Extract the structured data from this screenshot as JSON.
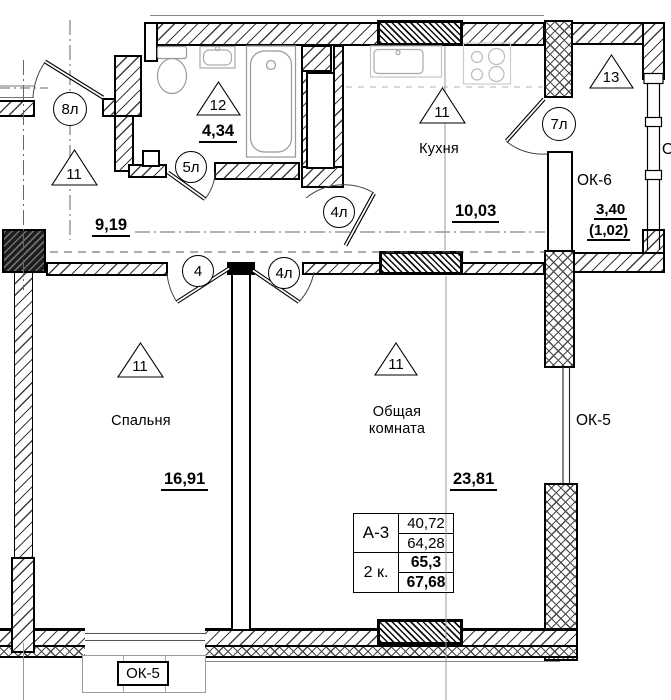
{
  "plan": {
    "rooms": {
      "hallway": {
        "zone": "11",
        "area": "9,19"
      },
      "bathroom": {
        "zone": "12",
        "area": "4,34"
      },
      "kitchen": {
        "name": "Кухня",
        "zone": "11",
        "area": "10,03"
      },
      "bedroom": {
        "name": "Спальня",
        "zone": "11",
        "area": "16,91"
      },
      "living_room": {
        "name_line1": "Общая",
        "name_line2": "комната",
        "zone": "11",
        "area": "23,81"
      },
      "loggia": {
        "zone": "13",
        "window_mark": "ОК-6",
        "area": "3,40",
        "area_reduced": "(1,02)"
      }
    },
    "door_tags": {
      "entrance": "8л",
      "bathroom": "5л",
      "bedroom": "4",
      "living_room": "4л",
      "kitchen": "4л",
      "loggia": "7л"
    },
    "window_tags": {
      "right": "ОК-5",
      "bottom": "ОК-5",
      "edge_partial": "О"
    },
    "info_table": {
      "series": "А-3",
      "flat_type": "2 к.",
      "living_area": "40,72",
      "area_without_loggia": "64,28",
      "area_with_coeff": "65,3",
      "total_area": "67,68"
    }
  }
}
